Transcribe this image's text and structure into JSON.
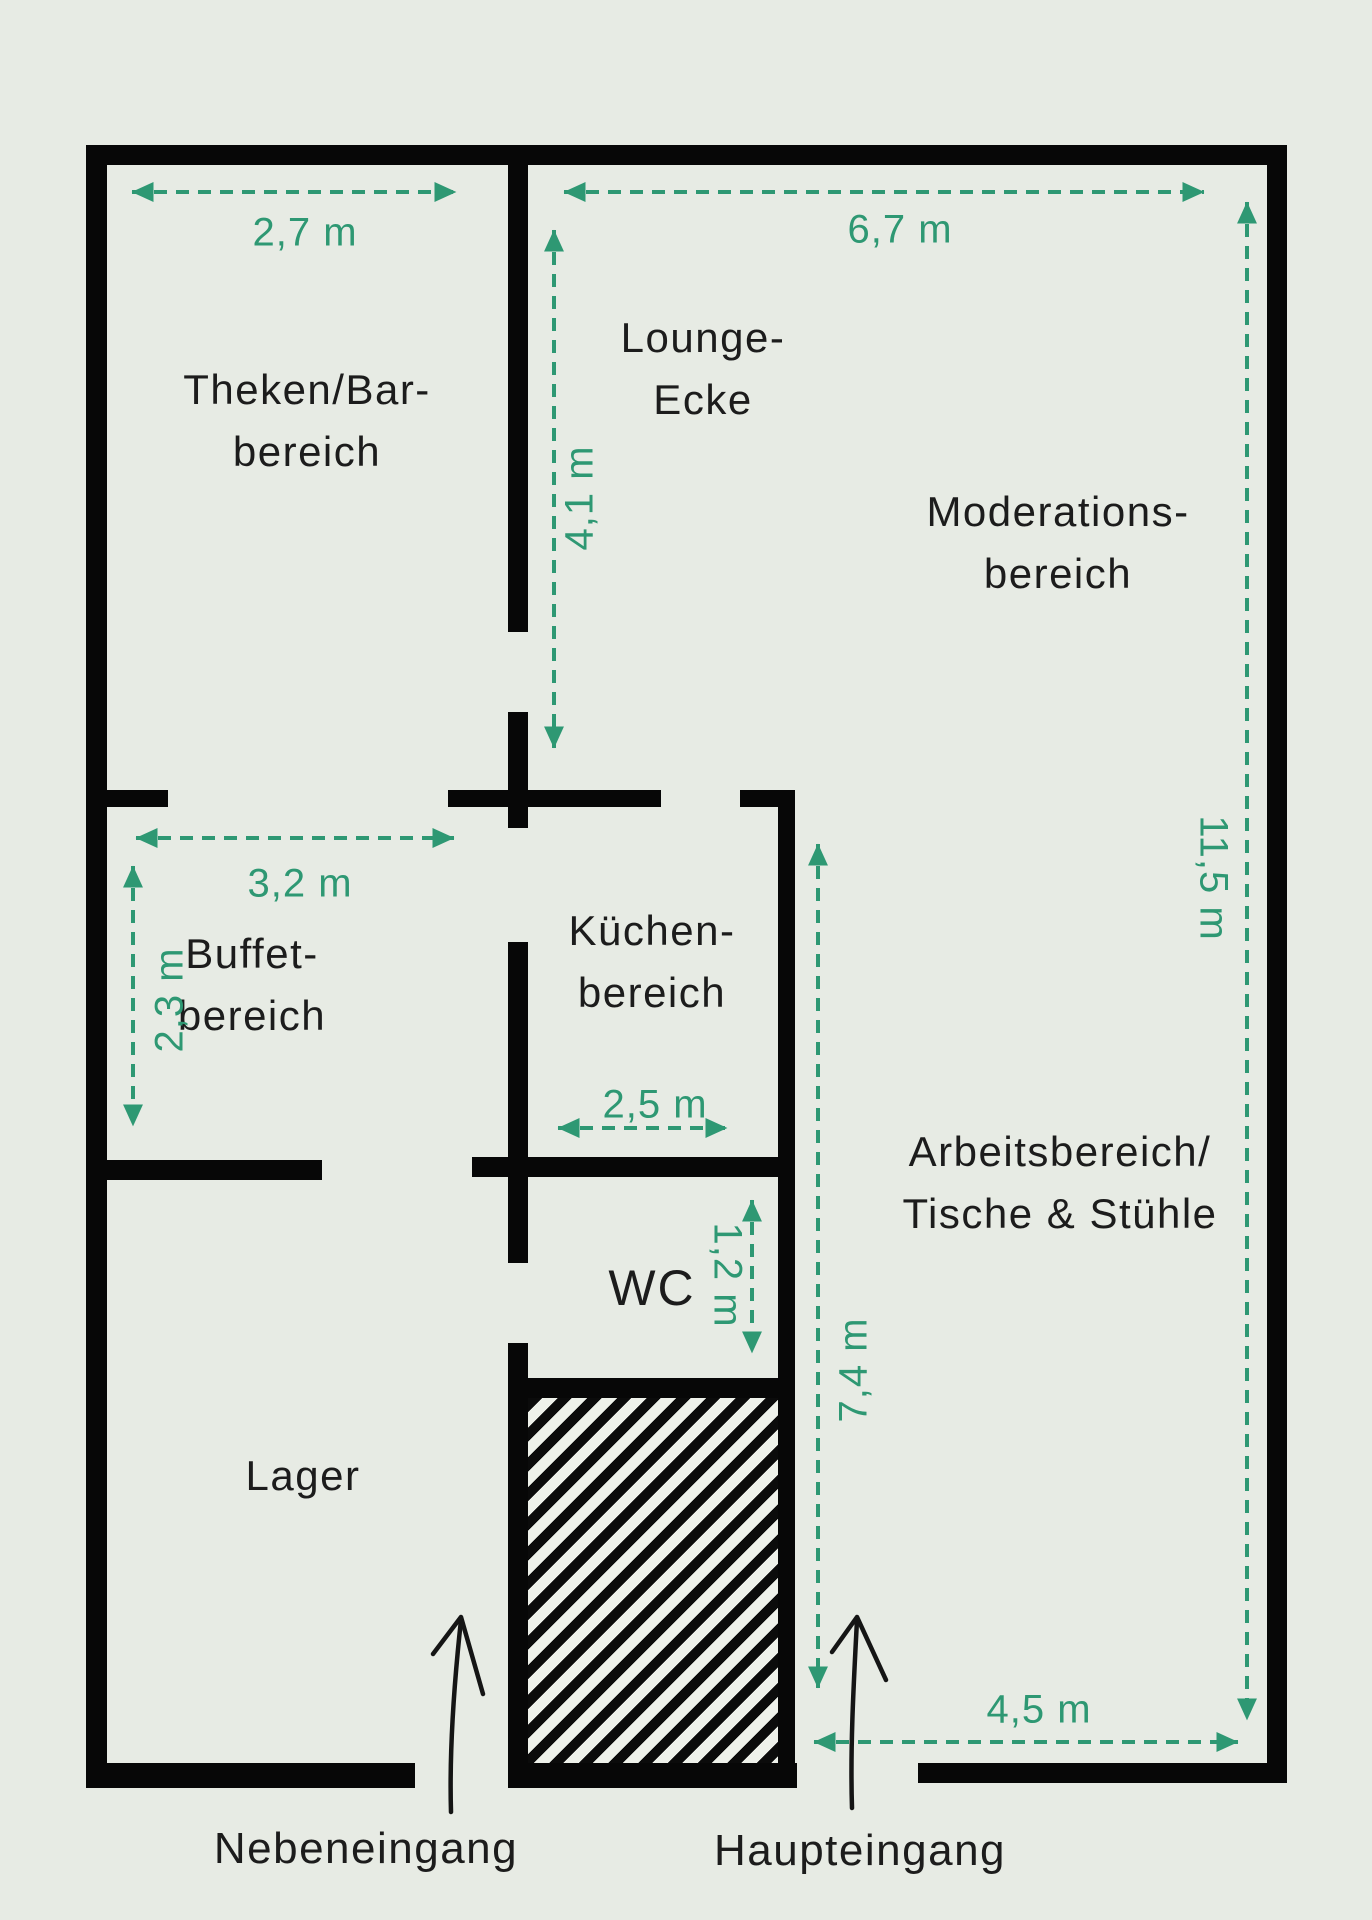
{
  "plan": {
    "rooms": {
      "theken_bar": {
        "line1": "Theken/Bar-",
        "line2": "bereich"
      },
      "lounge": {
        "line1": "Lounge-",
        "line2": "Ecke"
      },
      "moderation": {
        "line1": "Moderations-",
        "line2": "bereich"
      },
      "buffet": {
        "line1": "Buffet-",
        "line2": "bereich"
      },
      "kueche": {
        "line1": "Küchen-",
        "line2": "bereich"
      },
      "wc": {
        "label": "WC"
      },
      "arbeit": {
        "line1": "Arbeitsbereich/",
        "line2": "Tische & Stühle"
      },
      "lager": {
        "label": "Lager"
      }
    },
    "dimensions": {
      "theken_width": "2,7 m",
      "right_width": "6,7 m",
      "lounge_height": "4,1 m",
      "right_height": "11,5 m",
      "buffet_width": "3,2 m",
      "buffet_height": "2,3 m",
      "kueche_width": "2,5 m",
      "wc_height": "1,2 m",
      "arbeit_height": "7,4 m",
      "arbeit_width": "4,5 m"
    },
    "entrances": {
      "side": "Nebeneingang",
      "main": "Haupteingang"
    },
    "colors": {
      "dimension_green": "#2e9873",
      "wall_black": "#070707",
      "background": "#e7ebe4"
    }
  }
}
